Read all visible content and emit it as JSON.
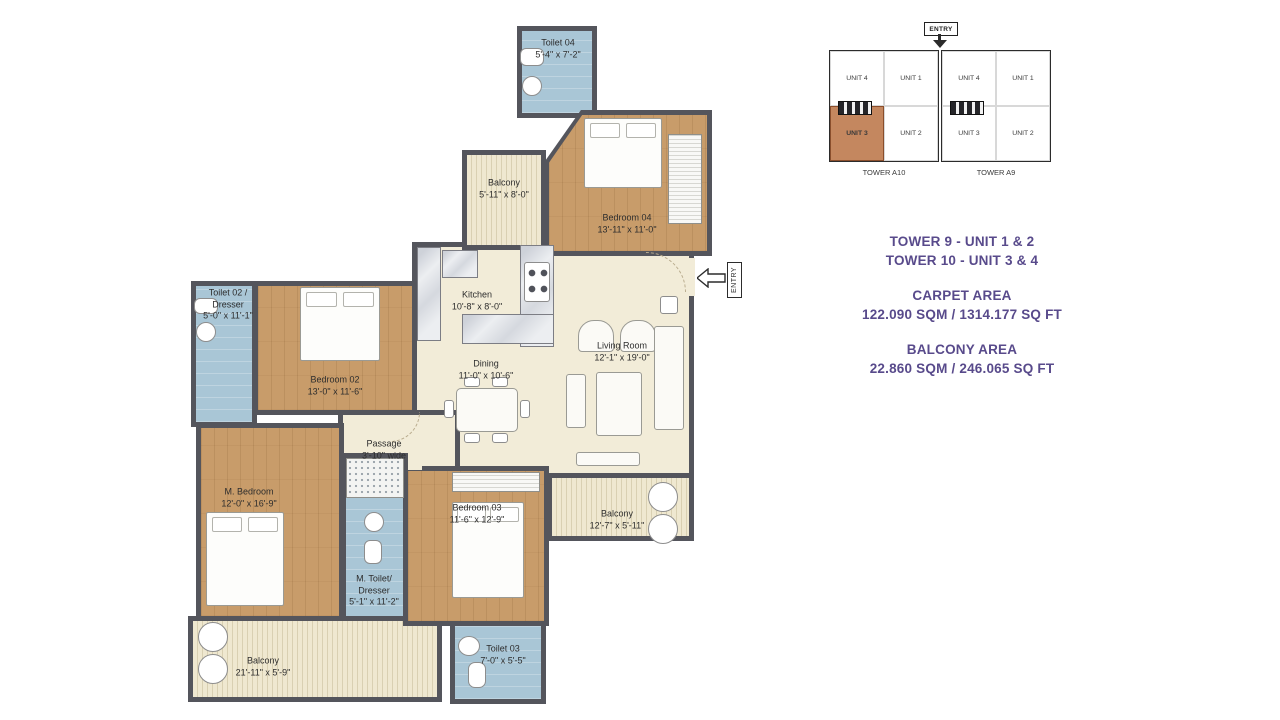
{
  "floor_plan": {
    "entry_label": "ENTRY",
    "rooms": [
      {
        "name": "Toilet 04",
        "dims": "5'-4\" x 7'-2\""
      },
      {
        "name": "Balcony",
        "dims": "5'-11\" x 8'-0\""
      },
      {
        "name": "Bedroom 04",
        "dims": "13'-11\" x 11'-0\""
      },
      {
        "name": "Kitchen",
        "dims": "10'-8\" x 8'-0\""
      },
      {
        "name": "Toilet 02 / Dresser",
        "dims": "5'-0\" x 11'-1\""
      },
      {
        "name": "Bedroom 02",
        "dims": "13'-0\" x 11'-6\""
      },
      {
        "name": "Dining",
        "dims": "11'-0\" x 10'-6\""
      },
      {
        "name": "Living Room",
        "dims": "12'-1\" x 19'-0\""
      },
      {
        "name": "Passage",
        "dims": "3'-10\" wide"
      },
      {
        "name": "M. Bedroom",
        "dims": "12'-0\" x 16'-9\""
      },
      {
        "name": "M. Toilet/ Dresser",
        "dims": "5'-1\" x 11'-2\""
      },
      {
        "name": "Bedroom 03",
        "dims": "11'-6\" x 12'-9\""
      },
      {
        "name": "Balcony",
        "dims": "21'-11\" x 5'-9\""
      },
      {
        "name": "Toilet 03",
        "dims": "7'-0\" x 5'-5\""
      },
      {
        "name": "Balcony",
        "dims": "12'-7\" x 5'-11\""
      }
    ]
  },
  "key_plan": {
    "entry_label": "ENTRY",
    "towers": [
      {
        "name": "TOWER A10",
        "units": [
          "UNIT 4",
          "UNIT 1",
          "UNIT 3",
          "UNIT 2"
        ]
      },
      {
        "name": "TOWER A9",
        "units": [
          "UNIT 4",
          "UNIT 1",
          "UNIT 3",
          "UNIT 2"
        ]
      }
    ],
    "highlighted_tower": "TOWER A10",
    "highlighted_unit": "UNIT 3",
    "highlight_style": "background:#c4875f;border:1px solid #8a4e2c;font-weight:bold;"
  },
  "info": {
    "tower_line_1": "TOWER 9 - UNIT 1 & 2",
    "tower_line_2": "TOWER 10 - UNIT 3 & 4",
    "carpet_area_label": "CARPET AREA",
    "carpet_area_value": "122.090 SQM / 1314.177 SQ FT",
    "balcony_area_label": "BALCONY AREA",
    "balcony_area_value": "22.860 SQM / 246.065 SQ FT",
    "text_color": "#584a8b",
    "highlight_color": "#c4875f",
    "wall_color": "#54555c"
  }
}
